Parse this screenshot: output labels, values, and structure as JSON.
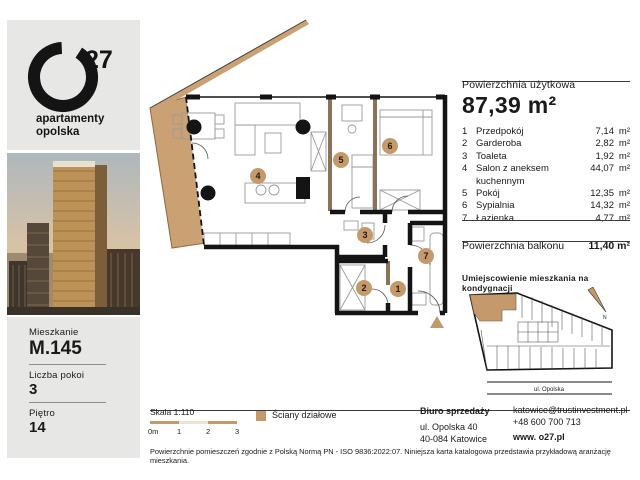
{
  "brand": {
    "logo_number": "27",
    "name_line1": "apartamenty",
    "name_line2": "opolska"
  },
  "unit": {
    "mieszkanie_label": "Mieszkanie",
    "number": "M.145",
    "pokoje_label": "Liczba pokoi",
    "rooms_count": "3",
    "pietro_label": "Piętro",
    "floor": "14"
  },
  "usable_area": {
    "label": "Powierzchnia użytkowa",
    "value": "87,39 m²"
  },
  "rooms": [
    {
      "no": "1",
      "name": "Przedpokój",
      "area": "7,14",
      "unit": "m²"
    },
    {
      "no": "2",
      "name": "Garderoba",
      "area": "2,82",
      "unit": "m²"
    },
    {
      "no": "3",
      "name": "Toaleta",
      "area": "1,92",
      "unit": "m²"
    },
    {
      "no": "4",
      "name": "Salon z aneksem kuchennym",
      "area": "44,07",
      "unit": "m²"
    },
    {
      "no": "5",
      "name": "Pokój",
      "area": "12,35",
      "unit": "m²"
    },
    {
      "no": "6",
      "name": "Sypialnia",
      "area": "14,32",
      "unit": "m²"
    },
    {
      "no": "7",
      "name": "Łazienka",
      "area": "4,77",
      "unit": "m²"
    }
  ],
  "balcony": {
    "label": "Powierzchnia balkonu",
    "value": "11,40 m²"
  },
  "location": {
    "label": "Umiejscowienie mieszkania na kondygnacji",
    "street": "ul. Opolska",
    "north": "N"
  },
  "plan": {
    "markers": [
      {
        "label": "1"
      },
      {
        "label": "2"
      },
      {
        "label": "3"
      },
      {
        "label": "4"
      },
      {
        "label": "5"
      },
      {
        "label": "6"
      },
      {
        "label": "7"
      }
    ]
  },
  "footer": {
    "scale_label": "Skala 1:110",
    "scale_ticks": [
      "0m",
      "1",
      "2",
      "3"
    ],
    "legend_label": "Ściany działowe",
    "office_title": "Biuro sprzedaży",
    "office_addr1": "ul. Opolska 40",
    "office_addr2": "40-084 Katowice",
    "email": "katowice@trustinvestment.pl",
    "phone": "+48 600 700 713",
    "web": "www. o27.pl",
    "disclaimer": "Powierzchnie pomieszczeń zgodnie z Polską Normą PN - ISO 9836:2022:07. Niniejsza karta katalogowa przedstawia przykładową aranżację mieszkania."
  },
  "colors": {
    "accent": "#c49a6c",
    "panel": "#e7e7e5",
    "wall": "#141414",
    "partition": "#8a7258"
  }
}
